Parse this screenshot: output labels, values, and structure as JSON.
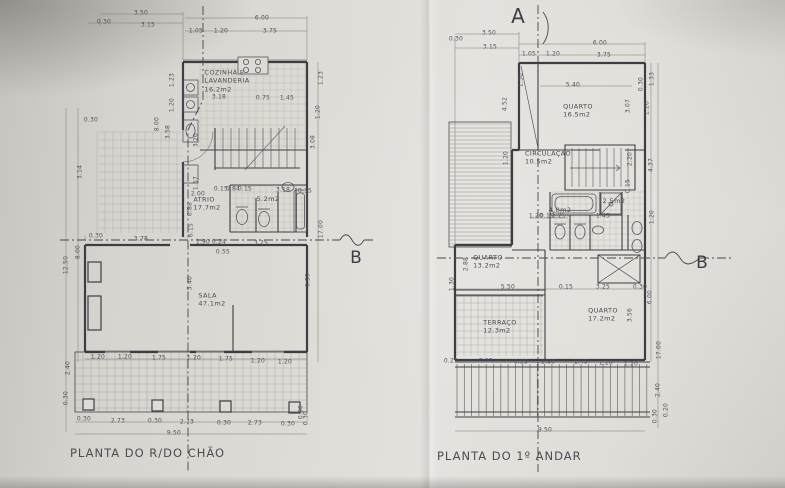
{
  "photo": {
    "paper_color": "#dedbd6",
    "line_color": "#3d3d44",
    "dim_color": "#50505a"
  },
  "section_markers": [
    {
      "t": "A",
      "x": 518,
      "y": 16,
      "s": 20
    },
    {
      "t": "B",
      "x": 356,
      "y": 258,
      "s": 17
    },
    {
      "t": "B",
      "x": 702,
      "y": 263,
      "s": 17
    }
  ],
  "left_plan": {
    "title": "PLANTA DO R/DO CHÃO",
    "rooms": [
      {
        "lines": [
          "COZINHA E",
          "LAVANDERIA",
          "16.2m2"
        ],
        "x": 227,
        "y": 81
      },
      {
        "lines": [
          "ATRIO",
          "17.7m2"
        ],
        "x": 207,
        "y": 204
      },
      {
        "lines": [
          "5.2m2"
        ],
        "x": 268,
        "y": 199
      },
      {
        "lines": [
          "SALA",
          "47.1m2"
        ],
        "x": 212,
        "y": 300
      }
    ],
    "dims": [
      {
        "t": "3.50",
        "x": 141,
        "y": 13
      },
      {
        "t": "0.30",
        "x": 104,
        "y": 22
      },
      {
        "t": "3.15",
        "x": 148,
        "y": 25
      },
      {
        "t": "6.00",
        "x": 262,
        "y": 18
      },
      {
        "t": "1.05",
        "x": 196,
        "y": 31
      },
      {
        "t": "1.20",
        "x": 221,
        "y": 31
      },
      {
        "t": "3.75",
        "x": 270,
        "y": 31
      },
      {
        "t": "1.23",
        "x": 172,
        "y": 80,
        "r": 1
      },
      {
        "t": "1.20",
        "x": 172,
        "y": 105,
        "r": 1
      },
      {
        "t": "1.23",
        "x": 321,
        "y": 78,
        "r": 1
      },
      {
        "t": "1.20",
        "x": 318,
        "y": 112,
        "r": 1
      },
      {
        "t": "3.18",
        "x": 219,
        "y": 97
      },
      {
        "t": "0.75",
        "x": 263,
        "y": 98
      },
      {
        "t": "1.45",
        "x": 287,
        "y": 98
      },
      {
        "t": "0.30",
        "x": 91,
        "y": 120
      },
      {
        "t": "3.14",
        "x": 80,
        "y": 172,
        "r": 1
      },
      {
        "t": "8.00",
        "x": 157,
        "y": 124,
        "r": 1
      },
      {
        "t": "3.58",
        "x": 168,
        "y": 132,
        "r": 1
      },
      {
        "t": "3.20",
        "x": 196,
        "y": 140,
        "r": 1
      },
      {
        "t": "3.08",
        "x": 313,
        "y": 142,
        "r": 1
      },
      {
        "t": "1.57",
        "x": 196,
        "y": 183,
        "r": 1
      },
      {
        "t": "0.88",
        "x": 190,
        "y": 209,
        "r": 1
      },
      {
        "t": "6.15",
        "x": 191,
        "y": 230,
        "r": 1
      },
      {
        "t": "2.00",
        "x": 198,
        "y": 194
      },
      {
        "t": "0.15",
        "x": 221,
        "y": 189
      },
      {
        "t": "0.84",
        "x": 233,
        "y": 189
      },
      {
        "t": "0.15",
        "x": 245,
        "y": 189
      },
      {
        "t": "3.18",
        "x": 283,
        "y": 190
      },
      {
        "t": "0.35",
        "x": 305,
        "y": 191
      },
      {
        "t": "17.00",
        "x": 321,
        "y": 229,
        "r": 1
      },
      {
        "t": "12.50",
        "x": 66,
        "y": 265,
        "r": 1
      },
      {
        "t": "8.00",
        "x": 78,
        "y": 252,
        "r": 1
      },
      {
        "t": "0.30",
        "x": 96,
        "y": 236
      },
      {
        "t": "3.78",
        "x": 141,
        "y": 239
      },
      {
        "t": "1.90",
        "x": 203,
        "y": 242
      },
      {
        "t": "0.24",
        "x": 219,
        "y": 242
      },
      {
        "t": "3.25",
        "x": 261,
        "y": 243
      },
      {
        "t": "0.55",
        "x": 223,
        "y": 252
      },
      {
        "t": "5.40",
        "x": 190,
        "y": 283,
        "r": 1
      },
      {
        "t": "6.39",
        "x": 308,
        "y": 280,
        "r": 1
      },
      {
        "t": "1.20",
        "x": 98,
        "y": 357
      },
      {
        "t": "1.20",
        "x": 125,
        "y": 357
      },
      {
        "t": "1.75",
        "x": 159,
        "y": 358
      },
      {
        "t": "1.20",
        "x": 194,
        "y": 358
      },
      {
        "t": "1.75",
        "x": 226,
        "y": 359
      },
      {
        "t": "1.20",
        "x": 258,
        "y": 361
      },
      {
        "t": "1.20",
        "x": 285,
        "y": 362
      },
      {
        "t": "2.40",
        "x": 68,
        "y": 368,
        "r": 1
      },
      {
        "t": "0.30",
        "x": 66,
        "y": 398,
        "r": 1
      },
      {
        "t": "0.30",
        "x": 84,
        "y": 419
      },
      {
        "t": "2.73",
        "x": 118,
        "y": 421
      },
      {
        "t": "0.30",
        "x": 155,
        "y": 421
      },
      {
        "t": "2.73",
        "x": 187,
        "y": 422
      },
      {
        "t": "0.30",
        "x": 224,
        "y": 423
      },
      {
        "t": "2.73",
        "x": 255,
        "y": 423
      },
      {
        "t": "0.30",
        "x": 288,
        "y": 424
      },
      {
        "t": "9.50",
        "x": 174,
        "y": 433
      },
      {
        "t": "0.30",
        "x": 301,
        "y": 412,
        "r": 1
      },
      {
        "t": "0.30",
        "x": 306,
        "y": 418,
        "r": 1
      }
    ]
  },
  "right_plan": {
    "title": "PLANTA DO 1º ANDAR",
    "rooms": [
      {
        "lines": [
          "QUARTO",
          "16.5m2"
        ],
        "x": 578,
        "y": 111
      },
      {
        "lines": [
          "CIRCULAÇÃO",
          "10.5m2"
        ],
        "x": 548,
        "y": 158
      },
      {
        "lines": [
          "4.0m2"
        ],
        "x": 560,
        "y": 210
      },
      {
        "lines": [
          "2.5m2"
        ],
        "x": 614,
        "y": 201
      },
      {
        "lines": [
          "QUARTO",
          "13.2m2"
        ],
        "x": 488,
        "y": 262
      },
      {
        "lines": [
          "TERRAÇO",
          "12.3m2"
        ],
        "x": 500,
        "y": 327
      },
      {
        "lines": [
          "QUARTO",
          "17.2m2"
        ],
        "x": 603,
        "y": 315
      }
    ],
    "dims": [
      {
        "t": "3.50",
        "x": 489,
        "y": 33
      },
      {
        "t": "0.30",
        "x": 456,
        "y": 39
      },
      {
        "t": "3.15",
        "x": 490,
        "y": 47
      },
      {
        "t": "6.00",
        "x": 600,
        "y": 43
      },
      {
        "t": "1.05",
        "x": 529,
        "y": 54
      },
      {
        "t": "1.20",
        "x": 553,
        "y": 54
      },
      {
        "t": "3.75",
        "x": 604,
        "y": 55
      },
      {
        "t": "5.40",
        "x": 573,
        "y": 85
      },
      {
        "t": "1.30",
        "x": 521,
        "y": 80,
        "r": 1
      },
      {
        "t": "4.52",
        "x": 505,
        "y": 104,
        "r": 1
      },
      {
        "t": "1.33",
        "x": 652,
        "y": 79,
        "r": 1
      },
      {
        "t": "0.30",
        "x": 641,
        "y": 84,
        "r": 1
      },
      {
        "t": "3.07",
        "x": 628,
        "y": 106,
        "r": 1
      },
      {
        "t": "1.20",
        "x": 647,
        "y": 108,
        "r": 1
      },
      {
        "t": "2.20",
        "x": 630,
        "y": 159,
        "r": 1
      },
      {
        "t": "4.37",
        "x": 651,
        "y": 165,
        "r": 1
      },
      {
        "t": "0.15",
        "x": 628,
        "y": 186,
        "r": 1
      },
      {
        "t": "1.20",
        "x": 506,
        "y": 158,
        "r": 1
      },
      {
        "t": "1.20",
        "x": 536,
        "y": 216
      },
      {
        "t": "0.15",
        "x": 547,
        "y": 216
      },
      {
        "t": "1.25",
        "x": 559,
        "y": 216
      },
      {
        "t": "1.45",
        "x": 603,
        "y": 216
      },
      {
        "t": "1.20",
        "x": 652,
        "y": 217,
        "r": 1
      },
      {
        "t": "2.88",
        "x": 466,
        "y": 264,
        "r": 1
      },
      {
        "t": "1.30",
        "x": 452,
        "y": 284,
        "r": 1
      },
      {
        "t": "5.50",
        "x": 508,
        "y": 287
      },
      {
        "t": "0.15",
        "x": 566,
        "y": 287
      },
      {
        "t": "3.25",
        "x": 603,
        "y": 287
      },
      {
        "t": "0.30",
        "x": 640,
        "y": 287
      },
      {
        "t": "6.00",
        "x": 650,
        "y": 297,
        "r": 1
      },
      {
        "t": "3.56",
        "x": 630,
        "y": 315,
        "r": 1
      },
      {
        "t": "17.00",
        "x": 659,
        "y": 350,
        "r": 1
      },
      {
        "t": "0.25",
        "x": 451,
        "y": 361
      },
      {
        "t": "3.15",
        "x": 486,
        "y": 361
      },
      {
        "t": "0.35",
        "x": 521,
        "y": 362
      },
      {
        "t": "1.80",
        "x": 548,
        "y": 362
      },
      {
        "t": "1.45",
        "x": 581,
        "y": 362
      },
      {
        "t": "1.20",
        "x": 606,
        "y": 363
      },
      {
        "t": "1.20",
        "x": 631,
        "y": 364
      },
      {
        "t": "9.50",
        "x": 545,
        "y": 430
      },
      {
        "t": "2.40",
        "x": 658,
        "y": 390,
        "r": 1
      },
      {
        "t": "0.30",
        "x": 655,
        "y": 416,
        "r": 1
      },
      {
        "t": "0.20",
        "x": 666,
        "y": 410,
        "r": 1
      }
    ]
  }
}
